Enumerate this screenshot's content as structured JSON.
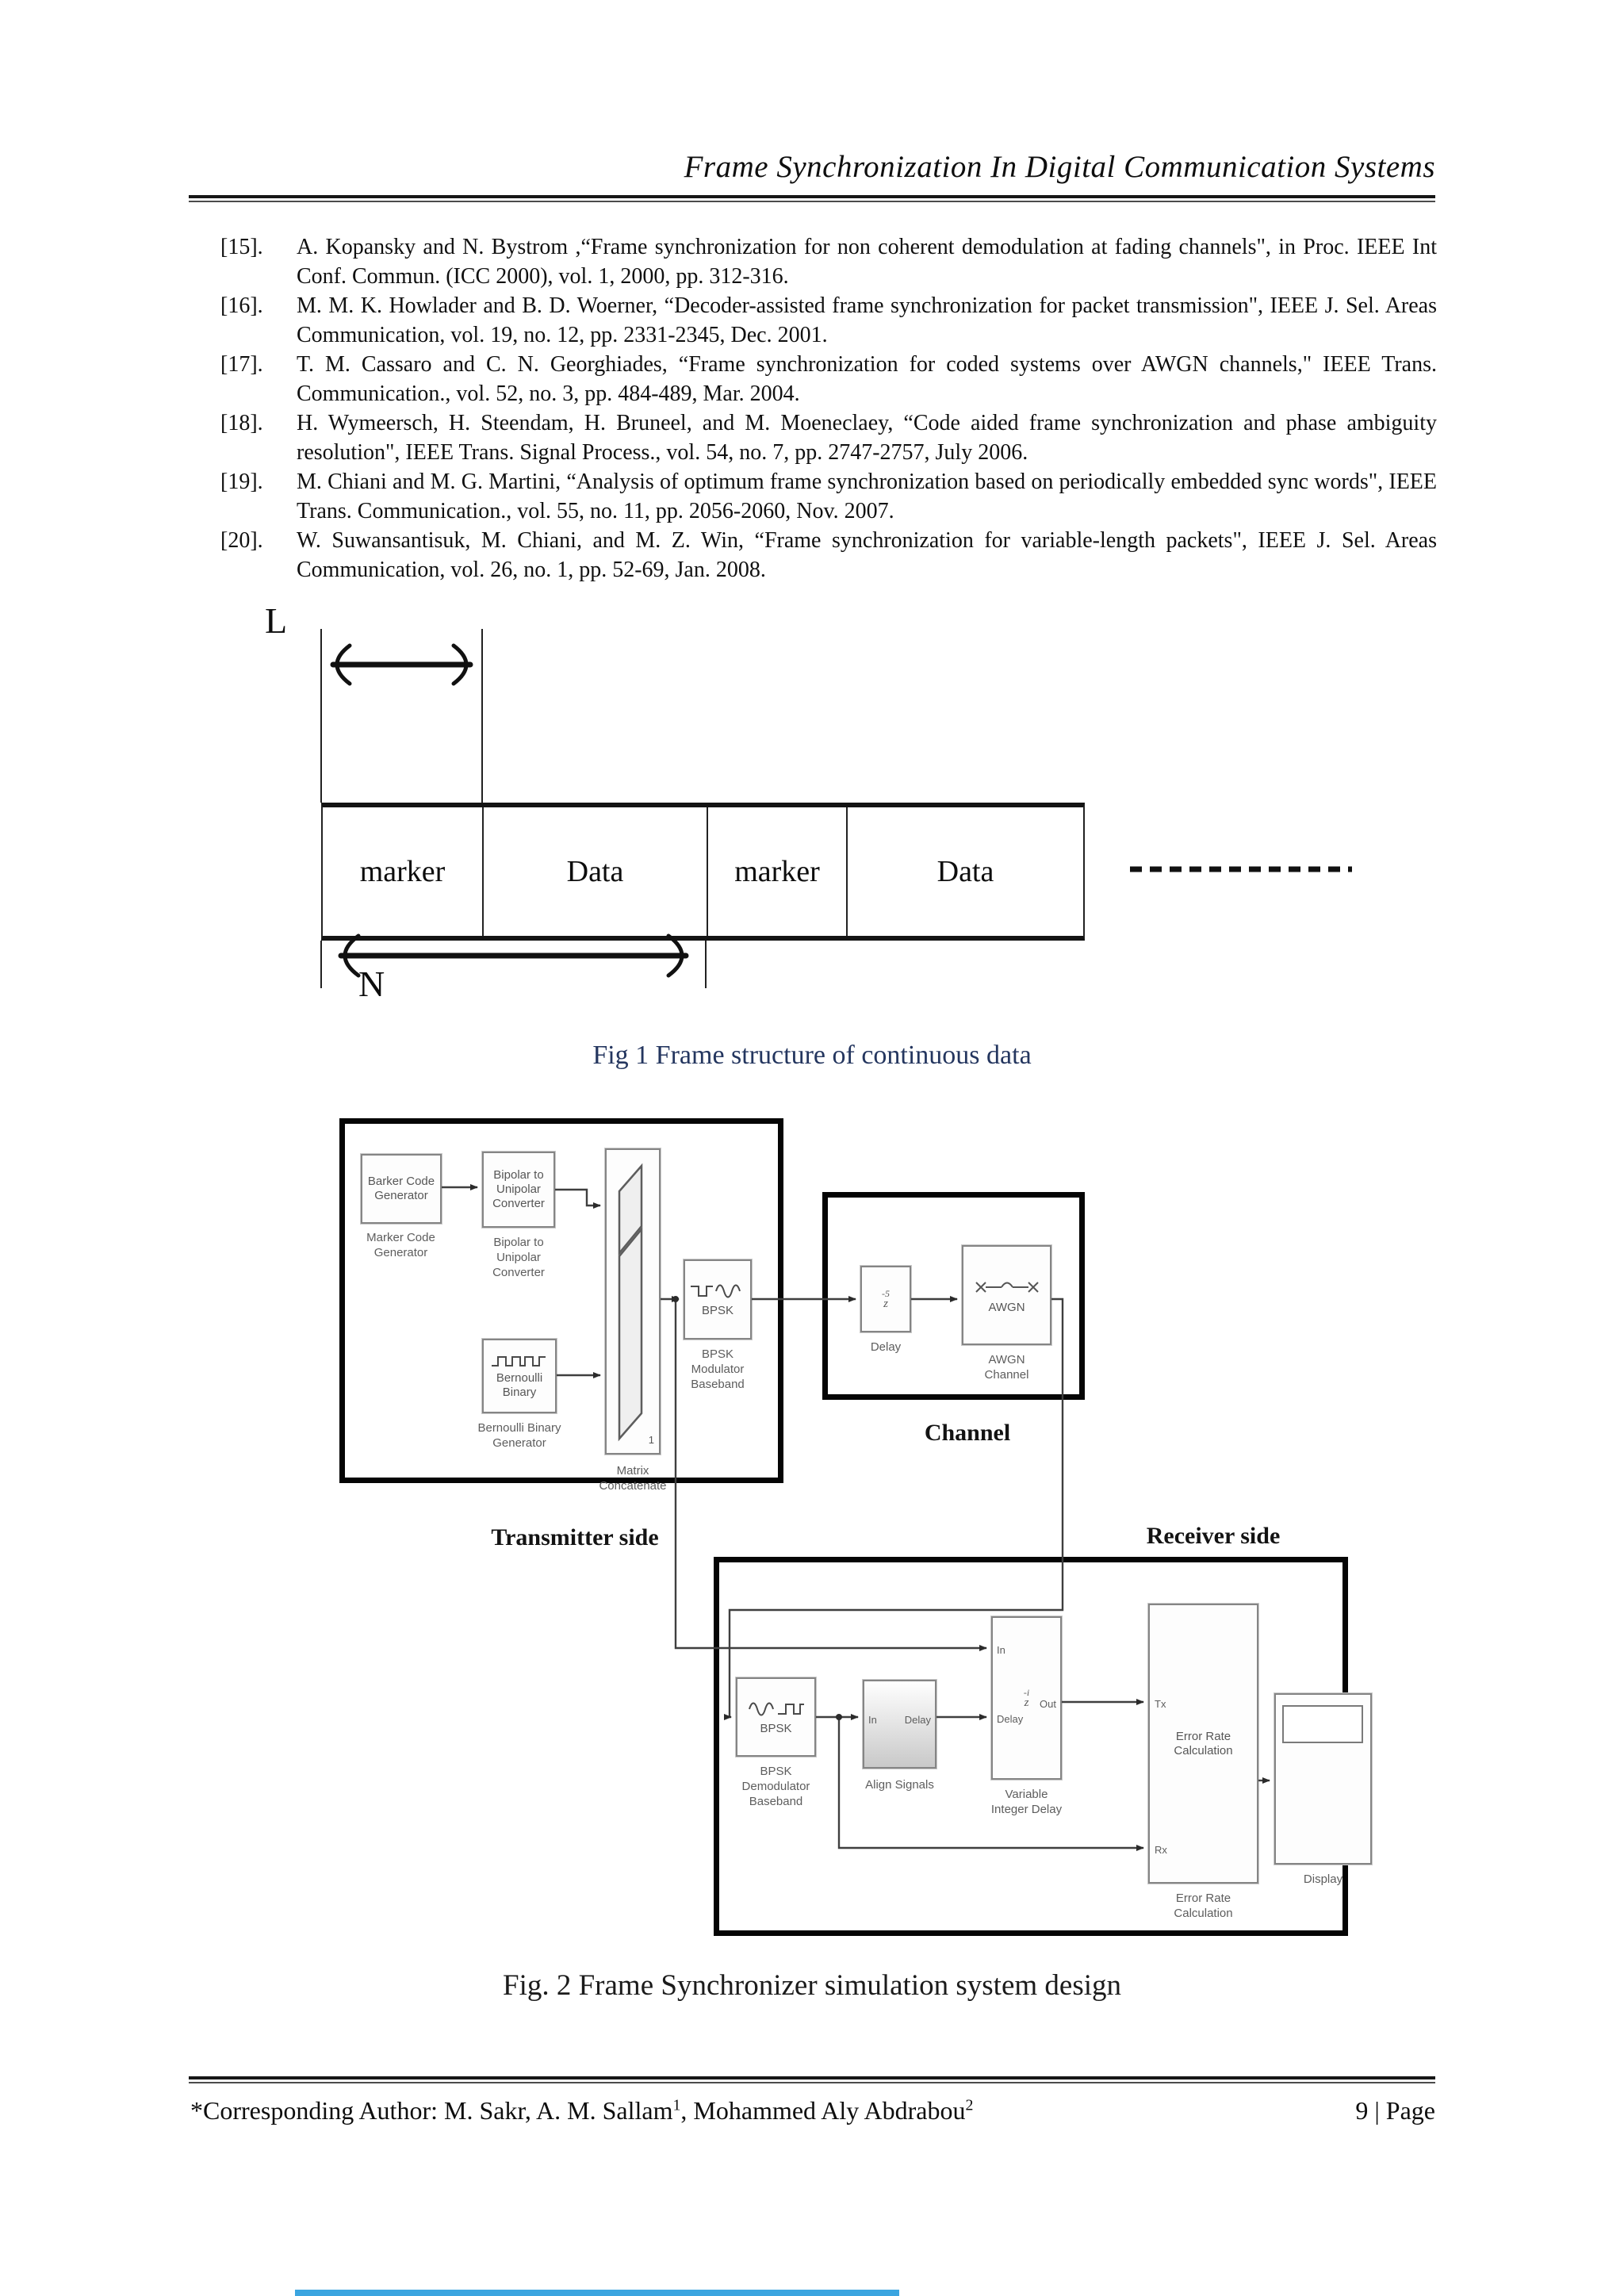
{
  "header": {
    "title": "Frame Synchronization In Digital Communication Systems"
  },
  "references": [
    {
      "num": "[15].",
      "text": "A. Kopansky and N. Bystrom ,“Frame synchronization for non coherent demodulation at fading channels\", in Proc. IEEE Int Conf. Commun. (ICC 2000), vol. 1, 2000, pp. 312-316."
    },
    {
      "num": "[16].",
      "text": "M. M. K. Howlader and B. D. Woerner, “Decoder-assisted frame synchronization for packet transmission\",  IEEE J. Sel. Areas Communication, vol. 19, no. 12, pp. 2331-2345, Dec. 2001."
    },
    {
      "num": "[17].",
      "text": "T. M. Cassaro and C. N. Georghiades,  “Frame synchronization  for coded  systems over AWGN channels,\" IEEE Trans. Communication., vol. 52, no. 3, pp. 484-489, Mar. 2004."
    },
    {
      "num": "[18].",
      "text": "H. Wymeersch, H. Steendam, H. Bruneel, and M. Moeneclaey, “Code aided frame synchronization and phase ambiguity resolution\",  IEEE Trans. Signal Process., vol. 54, no. 7, pp. 2747-2757, July 2006."
    },
    {
      "num": "[19].",
      "text": "M. Chiani and M. G. Martini, “Analysis of optimum frame synchronization based on periodically embedded sync words\", IEEE Trans. Communication., vol. 55, no. 11, pp. 2056-2060, Nov. 2007."
    },
    {
      "num": "[20].",
      "text": "W. Suwansantisuk, M. Chiani, and M. Z. Win, “Frame synchronization for variable-length packets\",  IEEE J. Sel. Areas Communication, vol. 26, no. 1, pp. 52-69, Jan. 2008."
    }
  ],
  "fig1": {
    "l_label": "L",
    "n_label": "N",
    "cells": [
      "marker",
      "Data",
      "marker",
      "Data"
    ],
    "caption": "Fig 1 Frame structure of continuous data"
  },
  "fig2": {
    "caption": "Fig. 2 Frame Synchronizer simulation system design",
    "transmitter_side_label": "Transmitter side",
    "receiver_side_label": "Receiver side",
    "channel_label": "Channel",
    "blocks": {
      "barker": {
        "text": "Barker Code\nGenerator",
        "label": "Marker Code\nGenerator"
      },
      "bipolar": {
        "text": "Bipolar to\nUnipolar\nConverter",
        "label": "Bipolar to\nUnipolar\nConverter"
      },
      "bernoulli": {
        "text": "Bernoulli\nBinary",
        "label": "Bernoulli Binary\nGenerator"
      },
      "matrix": {
        "icon_num": "1",
        "label": "Matrix\nConcatenate"
      },
      "bpsk_mod": {
        "text": "BPSK",
        "label": "BPSK\nModulator\nBaseband"
      },
      "delay": {
        "exp": "-5",
        "base": "z",
        "label": "Delay"
      },
      "awgn": {
        "text": "AWGN",
        "label": "AWGN\nChannel"
      },
      "bpsk_demod": {
        "text": "BPSK",
        "label": "BPSK\nDemodulator\nBaseband"
      },
      "align": {
        "port_in": "In",
        "port_delay": "Delay",
        "label": "Align Signals"
      },
      "var_delay": {
        "port_in": "In",
        "port_delay": "Delay",
        "port_out": "Out",
        "exp": "-i",
        "base": "z",
        "label": "Variable\nInteger Delay"
      },
      "error_rate": {
        "text": "Error Rate\nCalculation",
        "port_tx": "Tx",
        "port_rx": "Rx",
        "label": "Error Rate\nCalculation"
      },
      "display": {
        "label": "Display"
      }
    }
  },
  "footer": {
    "author_prefix": "*Corresponding Author:  M. Sakr, A. M. Sallam",
    "sup1": "1",
    "author_mid": ", Mohammed Aly Abdrabou",
    "sup2": "2",
    "page_number": "9 | Page"
  }
}
